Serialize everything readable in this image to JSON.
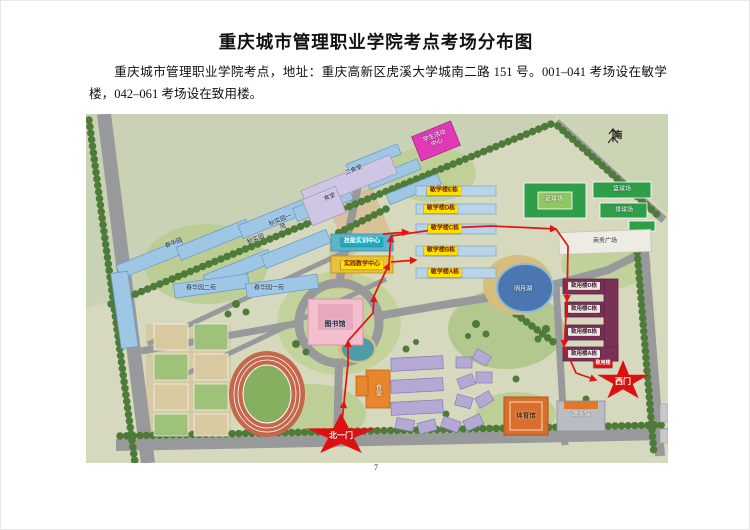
{
  "page": {
    "title": "重庆城市管理职业学院考点考场分布图",
    "body": "重庆城市管理职业学院考点，地址：重庆高新区虎溪大学城南二路 151 号。001–041 考场设在敏学楼，042–061 考场设在致用楼。",
    "page_number": "7"
  },
  "map": {
    "compass_label": "南",
    "gates": [
      {
        "name": "gate-north-1",
        "label": "北一门"
      },
      {
        "name": "gate-west",
        "label": "西门"
      }
    ],
    "colors": {
      "route_red": "#e41414",
      "gate_red": "#e01010",
      "minxue_chip_yellow": "#ffe000",
      "zhiyong_maroon": "#7a3157",
      "dorm_blue": "#9ec7e6",
      "canteen_lavender": "#cfc6e4"
    },
    "labels": [
      {
        "name": "label-canteen-2",
        "text": "二食堂",
        "x": 268,
        "y": 57,
        "cls": "t-dark rot22"
      },
      {
        "name": "label-canteen",
        "text": "食堂",
        "x": 244,
        "y": 84,
        "cls": "t-dark rot22"
      },
      {
        "name": "label-activity-center",
        "text": "学生活动中心",
        "x": 350,
        "y": 26,
        "cls": "t-white w26 rot22"
      },
      {
        "name": "label-chunhua-yuan",
        "text": "春华园",
        "x": 88,
        "y": 130,
        "cls": "t-dark rot22"
      },
      {
        "name": "label-qiushi-yuan",
        "text": "秋实园",
        "x": 170,
        "y": 126,
        "cls": "t-dark rot22"
      },
      {
        "name": "label-qiushi-yuan-1",
        "text": "秋实园一苑",
        "x": 196,
        "y": 110,
        "cls": "t-dark w24 rot22"
      },
      {
        "name": "label-chunhua-2",
        "text": "春华园二苑",
        "x": 115,
        "y": 175,
        "cls": "t-dark"
      },
      {
        "name": "label-chunhua-1",
        "text": "春华园一苑",
        "x": 183,
        "y": 175,
        "cls": "t-dark"
      },
      {
        "name": "label-skills-training-center",
        "text": "技能实训中心",
        "x": 276,
        "y": 128,
        "cls": "chip chip-cyan"
      },
      {
        "name": "label-practice-teaching-center",
        "text": "实践教学中心",
        "x": 276,
        "y": 151,
        "cls": "chip chip-yellow"
      },
      {
        "name": "label-library",
        "text": "图书馆",
        "x": 249,
        "y": 211,
        "cls": "t-dark fs7"
      },
      {
        "name": "label-minxue-e",
        "text": "敏学楼E栋",
        "x": 358,
        "y": 77,
        "cls": "chip chip-yellow"
      },
      {
        "name": "label-minxue-d",
        "text": "敏学楼D栋",
        "x": 355,
        "y": 95,
        "cls": "chip chip-yellow"
      },
      {
        "name": "label-minxue-c",
        "text": "敏学楼C栋",
        "x": 359,
        "y": 115,
        "cls": "chip chip-yellow"
      },
      {
        "name": "label-minxue-b",
        "text": "敏学楼B栋",
        "x": 355,
        "y": 137,
        "cls": "chip chip-yellow"
      },
      {
        "name": "label-minxue-a",
        "text": "敏学楼A栋",
        "x": 359,
        "y": 159,
        "cls": "chip chip-yellow"
      },
      {
        "name": "label-football-field",
        "text": "足球场",
        "x": 468,
        "y": 86,
        "cls": "t-white"
      },
      {
        "name": "label-basketball-court",
        "text": "篮球场",
        "x": 536,
        "y": 76,
        "cls": "t-white"
      },
      {
        "name": "label-volleyball-court",
        "text": "排球场",
        "x": 538,
        "y": 97,
        "cls": "t-white"
      },
      {
        "name": "label-business-plaza",
        "text": "商务广场",
        "x": 519,
        "y": 128,
        "cls": "t-dark"
      },
      {
        "name": "label-lake",
        "text": "明月湖",
        "x": 437,
        "y": 176,
        "cls": "t-white"
      },
      {
        "name": "label-zhiyong-d",
        "text": "致用楼D栋",
        "x": 498,
        "y": 172,
        "cls": "chip chip-white"
      },
      {
        "name": "label-zhiyong-c",
        "text": "致用楼C栋",
        "x": 498,
        "y": 195,
        "cls": "chip chip-white"
      },
      {
        "name": "label-zhiyong-b",
        "text": "致用楼B栋",
        "x": 498,
        "y": 218,
        "cls": "chip chip-white"
      },
      {
        "name": "label-zhiyong-a",
        "text": "致用楼A栋",
        "x": 498,
        "y": 240,
        "cls": "chip chip-white"
      },
      {
        "name": "label-zhiyong-sign",
        "text": "致用楼",
        "x": 517,
        "y": 250,
        "cls": "chip chip-red"
      },
      {
        "name": "label-gymnasium",
        "text": "体育馆",
        "x": 440,
        "y": 302,
        "cls": "t-dark fs6"
      },
      {
        "name": "label-natatorium",
        "text": "游泳馆",
        "x": 495,
        "y": 301,
        "cls": "t-white"
      },
      {
        "name": "label-canteen-3",
        "text": "食堂",
        "x": 291,
        "y": 276,
        "cls": "t-white vert"
      }
    ]
  }
}
